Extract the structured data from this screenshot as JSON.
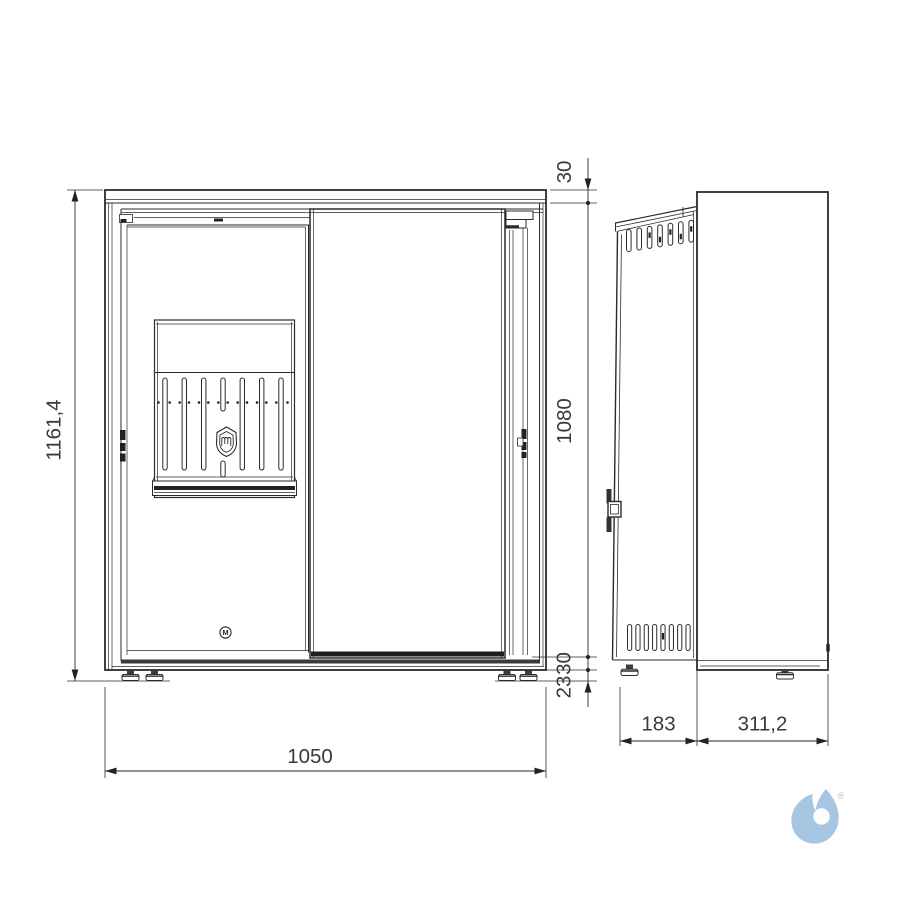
{
  "colors": {
    "line": "#2b2b2b",
    "dark_fill": "#222222",
    "base_band": "#3a3a3a",
    "watermark_blue": "#a6c6e1",
    "background": "#ffffff"
  },
  "front_view": {
    "dim_total_height": "1161,4",
    "dim_total_width": "1050",
    "dim_top_cap": "30",
    "dim_body_height": "1080",
    "dim_base": "30",
    "dim_feet": "23",
    "door_logo_letter": "M"
  },
  "side_view": {
    "dim_front_depth": "183",
    "dim_body_depth": "311,2"
  },
  "watermark": {
    "registered_mark": "®"
  }
}
